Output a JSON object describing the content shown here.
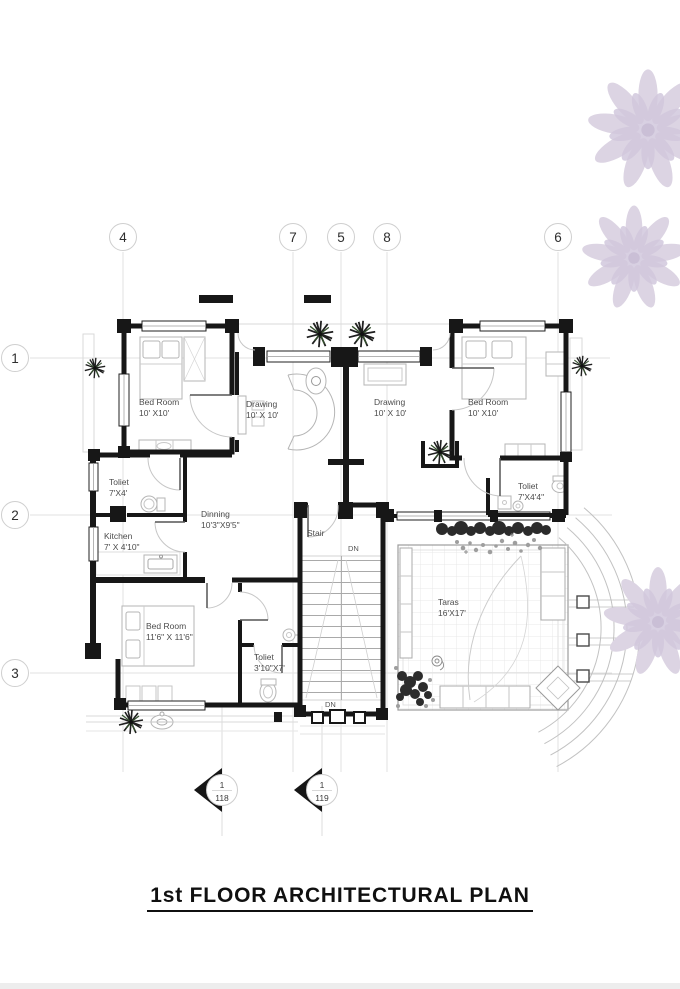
{
  "title": "1st FLOOR ARCHITECTURAL PLAN",
  "grid_markers": {
    "top": [
      "4",
      "7",
      "5",
      "8",
      "6"
    ],
    "left": [
      "1",
      "2",
      "3"
    ]
  },
  "rooms": {
    "bedroom_top_left": {
      "name": "Bed Room",
      "dims": "10' X10'"
    },
    "drawing_left": {
      "name": "Drawing",
      "dims": "10' X 10'"
    },
    "drawing_right": {
      "name": "Drawing",
      "dims": "10' X 10'"
    },
    "bedroom_top_right": {
      "name": "Bed Room",
      "dims": "10' X10'"
    },
    "toilet_left": {
      "name": "Toliet",
      "dims": "7'X4'"
    },
    "toilet_right": {
      "name": "Toliet",
      "dims": "7'X4'4\""
    },
    "kitchen": {
      "name": "Kitchen",
      "dims": "7' X 4'10\""
    },
    "dinning": {
      "name": "Dinning",
      "dims": "10'3\"X9'5\""
    },
    "stair": {
      "name": "Stair",
      "dims": ""
    },
    "bedroom_bottom": {
      "name": "Bed Room",
      "dims": "11'6\" X 11'6\""
    },
    "toilet_bottom": {
      "name": "Toliet",
      "dims": "3'10\"X7'"
    },
    "taras": {
      "name": "Taras",
      "dims": "16'X17'"
    }
  },
  "stair_notes": {
    "dn_top": "DN",
    "dn_bottom": "DN"
  },
  "section_markers": [
    {
      "num": "1",
      "sheet": "118"
    },
    {
      "num": "1",
      "sheet": "119"
    }
  ],
  "colors": {
    "wall": "#171717",
    "light_line": "#c9c9c9",
    "grid": "#e3e3e3",
    "tree": "#dcd4e3",
    "plant": "#1f1f1f",
    "hedge": "#2b2b2b"
  }
}
